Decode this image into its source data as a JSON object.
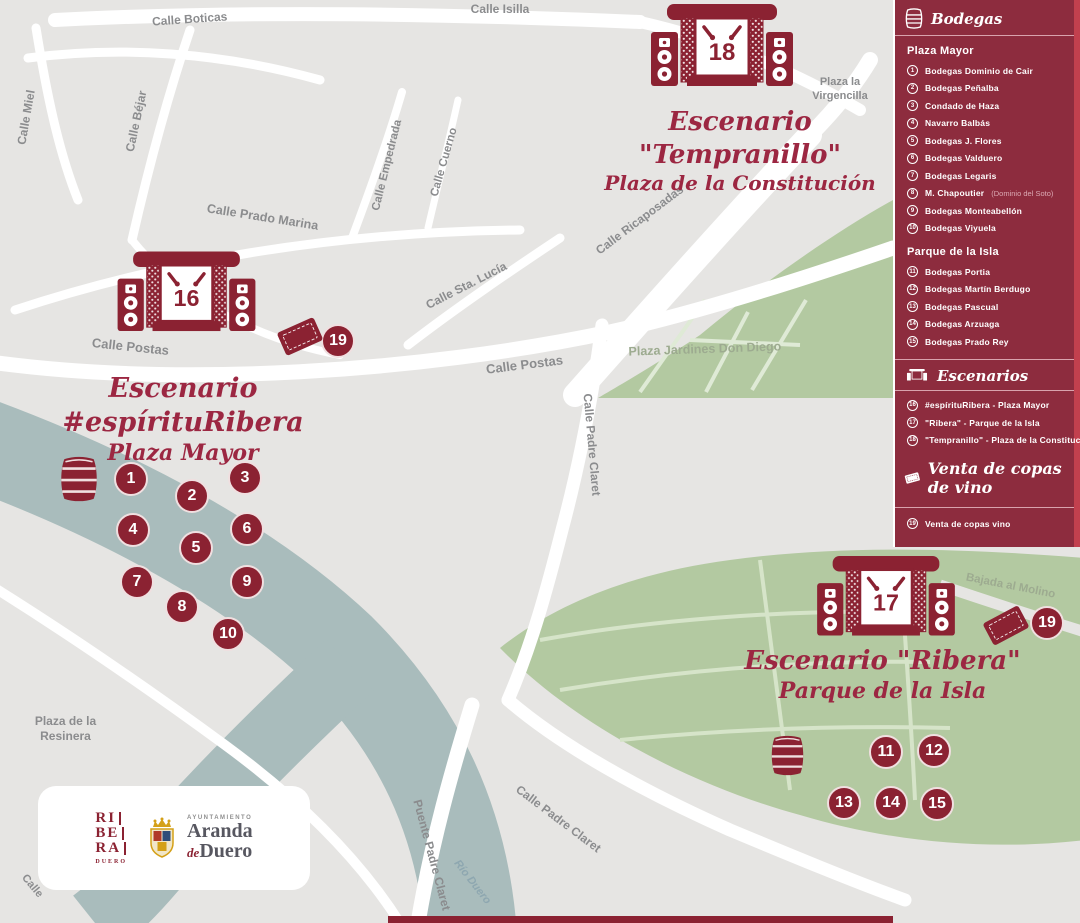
{
  "sidebar": {
    "bodegas": {
      "title": "Bodegas",
      "plaza_mayor": {
        "title": "Plaza Mayor",
        "items": [
          {
            "n": "1",
            "name": "Bodegas Dominio de Cair"
          },
          {
            "n": "2",
            "name": "Bodegas Peñalba"
          },
          {
            "n": "3",
            "name": "Condado de Haza"
          },
          {
            "n": "4",
            "name": "Navarro Balbás"
          },
          {
            "n": "5",
            "name": "Bodegas J. Flores"
          },
          {
            "n": "6",
            "name": "Bodegas Valduero"
          },
          {
            "n": "7",
            "name": "Bodegas Legaris"
          },
          {
            "n": "8",
            "name": "M. Chapoutier",
            "note": "(Dominio del Soto)"
          },
          {
            "n": "9",
            "name": "Bodegas Monteabellón"
          },
          {
            "n": "10",
            "name": "Bodegas Viyuela"
          }
        ]
      },
      "parque": {
        "title": "Parque de la Isla",
        "items": [
          {
            "n": "11",
            "name": "Bodegas Portia"
          },
          {
            "n": "12",
            "name": "Bodegas Martín Berdugo"
          },
          {
            "n": "13",
            "name": "Bodegas Pascual"
          },
          {
            "n": "14",
            "name": "Bodegas Arzuaga"
          },
          {
            "n": "15",
            "name": "Bodegas Prado Rey"
          }
        ]
      }
    },
    "escenarios": {
      "title": "Escenarios",
      "items": [
        {
          "n": "16",
          "name": "#espírituRibera - Plaza Mayor"
        },
        {
          "n": "17",
          "name": "\"Ribera\" - Parque de la Isla"
        },
        {
          "n": "18",
          "name": "\"Tempranillo\" - Plaza de la Constitución"
        }
      ]
    },
    "venta": {
      "title": "Venta de copas de vino",
      "items": [
        {
          "n": "19",
          "name": "Venta de copas vino"
        }
      ]
    }
  },
  "map": {
    "stages": {
      "espiritu": {
        "number": "16",
        "title": "Escenario #espírituRibera",
        "subtitle": "Plaza Mayor"
      },
      "tempranillo": {
        "number": "18",
        "title": "Escenario \"Tempranillo\"",
        "subtitle": "Plaza de la Constitución"
      },
      "ribera": {
        "number": "17",
        "title": "Escenario \"Ribera\"",
        "subtitle": "Parque de la Isla"
      }
    },
    "streets": {
      "isilla": "Calle Isilla",
      "boticas": "Calle Boticas",
      "miel": "Calle Miel",
      "bejar": "Calle Béjar",
      "empedrada": "Calle Empedrada",
      "cuerno": "Calle Cuerno",
      "prado_marina": "Calle Prado Marina",
      "postas_w": "Calle Postas",
      "postas_c": "Calle Postas",
      "sta_lucia": "Calle Sta. Lucía",
      "ricaposadas": "Calle Ricaposadas",
      "padre_claret_v": "Calle Padre Claret",
      "padre_claret_d": "Calle Padre Claret",
      "puente": "Puente Padre Claret",
      "rio": "Río Duero",
      "bajada": "Bajada al Molino",
      "calle_cut": "Calle"
    },
    "places": {
      "virgencilla": "Plaza la\nVirgencilla",
      "jardines": "Plaza Jardines Don Diego",
      "resinera": "Plaza de la\nResinera"
    },
    "markers": [
      {
        "label": "1"
      },
      {
        "label": "2"
      },
      {
        "label": "3"
      },
      {
        "label": "4"
      },
      {
        "label": "5"
      },
      {
        "label": "6"
      },
      {
        "label": "7"
      },
      {
        "label": "8"
      },
      {
        "label": "9"
      },
      {
        "label": "10"
      },
      {
        "label": "11"
      },
      {
        "label": "12"
      },
      {
        "label": "13"
      },
      {
        "label": "14"
      },
      {
        "label": "15"
      },
      {
        "label": "19"
      },
      {
        "label": "19"
      }
    ]
  },
  "footer": {
    "ribera_logo": {
      "l1": "RI",
      "l2": "BE",
      "l3": "RA",
      "sub": "DUERO"
    },
    "ayuntamiento": {
      "small": "AYUNTAMIENTO",
      "line1": "Aranda",
      "line2": "Duero",
      "de": "de"
    }
  },
  "colors": {
    "maroon": "#8b2232",
    "sidebar": "#8d2c3e",
    "accent_stripe": "#c2404e",
    "park": "#b3c9a1",
    "river": "#a9bcbc",
    "script_red": "#9c2742",
    "map_bg": "#e6e5e3"
  }
}
